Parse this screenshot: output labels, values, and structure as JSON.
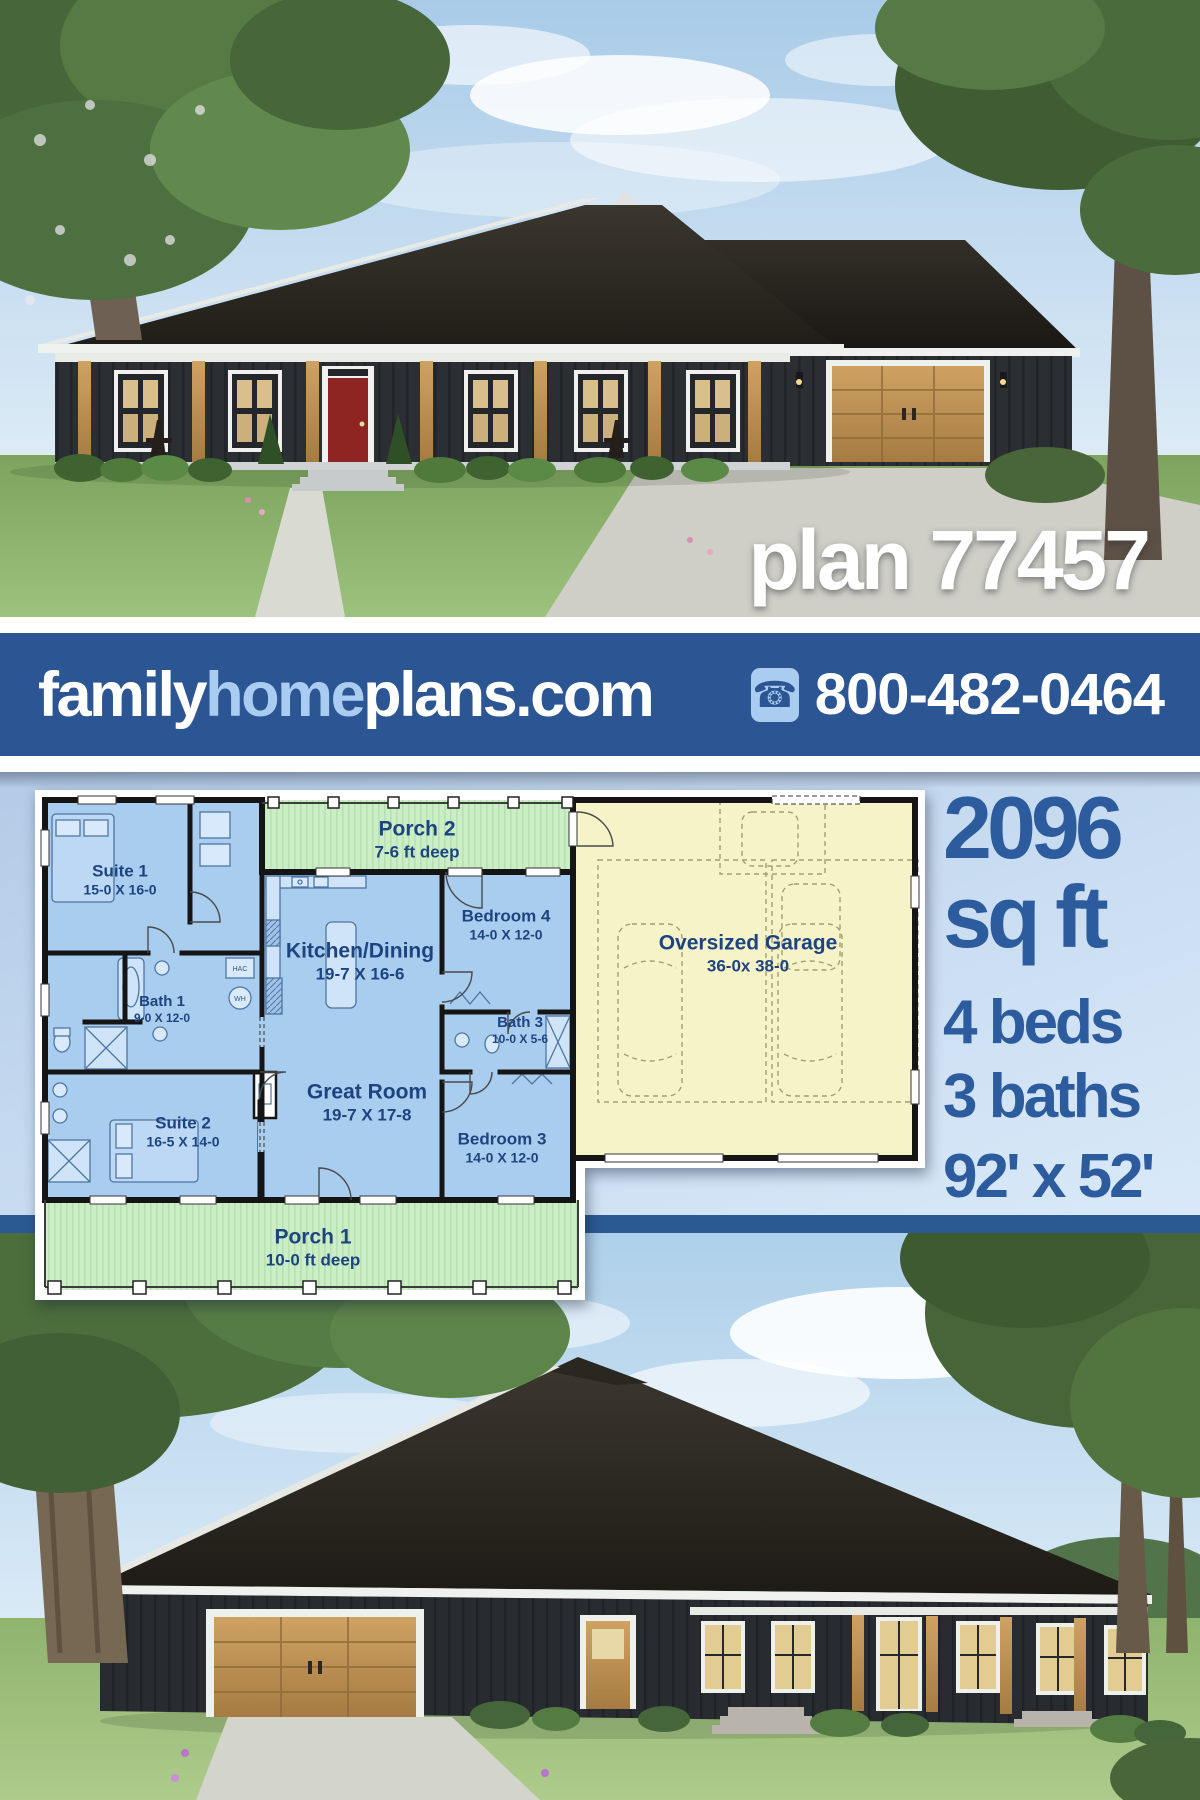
{
  "hero_top": {
    "plan_label": "plan 77457"
  },
  "banner": {
    "site_family": "family",
    "site_home": "home",
    "site_plans": "plans.com",
    "phone": "800-482-0464"
  },
  "stats": {
    "area_value": "2096",
    "area_unit": "sq ft",
    "beds": "4 beds",
    "baths": "3 baths",
    "footprint": "92' x 52'"
  },
  "floorplan": {
    "rooms": [
      {
        "name": "Suite 1",
        "dims": "15-0 X 16-0"
      },
      {
        "name": "Porch 2",
        "dims": "7-6 ft deep"
      },
      {
        "name": "Bedroom 4",
        "dims": "14-0 X 12-0"
      },
      {
        "name": "Kitchen/Dining",
        "dims": "19-7 X 16-6"
      },
      {
        "name": "Bath 1",
        "dims": "9-0 X 12-0"
      },
      {
        "name": "Bath 3",
        "dims": "10-0 X 5-6"
      },
      {
        "name": "Suite 2",
        "dims": "16-5 X 14-0"
      },
      {
        "name": "Great Room",
        "dims": "19-7 X 17-8"
      },
      {
        "name": "Bedroom 3",
        "dims": "14-0 X 12-0"
      },
      {
        "name": "Oversized Garage",
        "dims": "36-0x 38-0"
      },
      {
        "name": "Porch 1",
        "dims": "10-0 ft deep"
      }
    ],
    "fixtures": {
      "hac": "HAC",
      "wh": "WH"
    }
  },
  "colors": {
    "banner_blue": "#2b5593",
    "logo_light_blue": "#a9ccf0",
    "stats_blue": "#2d5c9e",
    "room_blue": "#a9cdef",
    "porch_green": "#cbeec6",
    "garage_yellow": "#f6f3c8"
  }
}
